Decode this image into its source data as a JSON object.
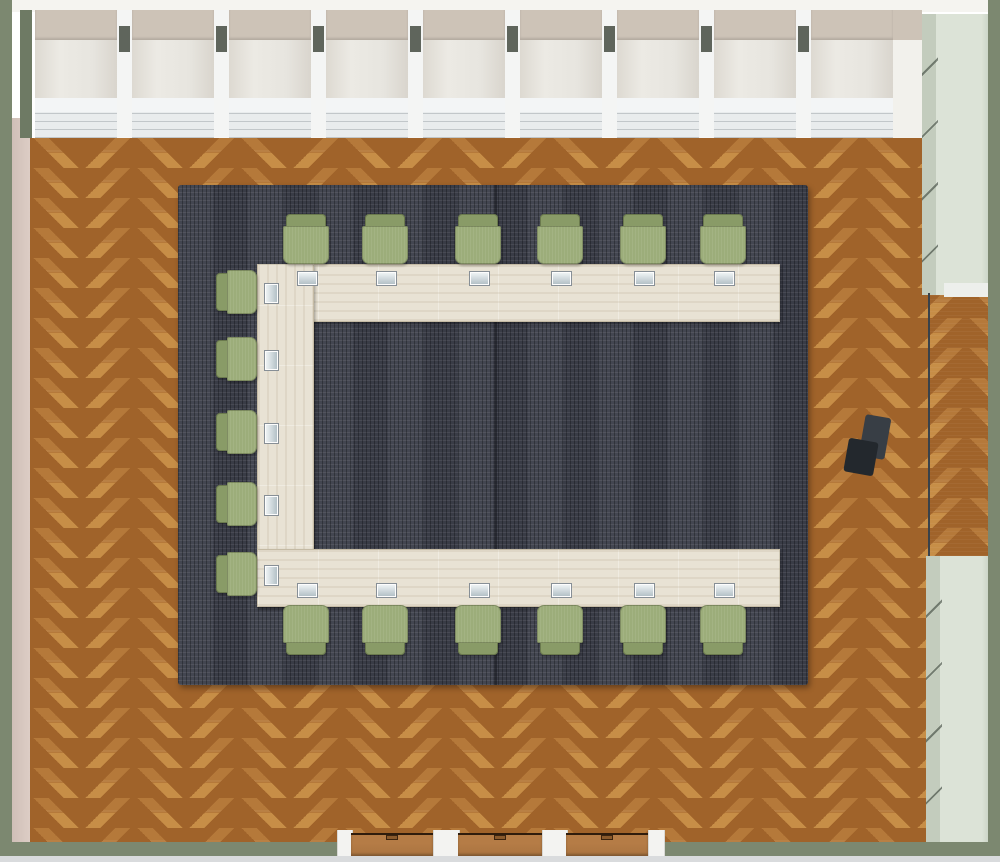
{
  "scene": {
    "description": "Top-down 3D floor plan of a conference room with a C-shaped whitewashed wood table, 17 sage-green chairs, place cards, dark woven rug on herringbone parquet, window wall at top, three wooden doors at bottom, sage storage cabinets and a dark wall niche on the right",
    "counts": {
      "chairs": 17,
      "place_cards": 17,
      "window_units": 9,
      "doors": 3,
      "cabinets": 2,
      "rugs": 1,
      "tables": 1
    },
    "colors": {
      "floor_wood": "#b5793a",
      "floor_wood_dark": "#a0632a",
      "floor_wood_light": "#c78e47",
      "rug": "#3d404b",
      "table_wood": "#e8e2d4",
      "chair_seat": "#9cad7a",
      "chair_back": "#899b67",
      "wall_sage": "#7c8870",
      "wall_inner_pink": "#d8c8c0",
      "window_beige": "#cdc3b7",
      "window_pane": "#e7e5df",
      "window_sill": "#e9eced",
      "mullion_cap": "#5f655c",
      "cabinet_sage": "#dce3d7",
      "niche_dark": "#4d565e",
      "door_wood": "#aa7440",
      "place_card": "#dfe8eb",
      "dark_object": "#2e3338"
    },
    "windows": {
      "count": 9,
      "start_x": 35,
      "unit_width": 82,
      "gap": 15
    },
    "chairs": {
      "top_row_centers_x": [
        306,
        385,
        478,
        560,
        643,
        723
      ],
      "top_row_y": 214,
      "bottom_row_centers_x": [
        306,
        385,
        478,
        560,
        643,
        723
      ],
      "bottom_row_y": 605,
      "left_col_centers_y": [
        292,
        359,
        432,
        504,
        574
      ],
      "left_col_x": 216
    },
    "cards": {
      "top_row_y": 272,
      "bottom_row_y": 584,
      "left_col_x": 265
    },
    "doors": {
      "jambs": [
        {
          "x": 337,
          "w": 14
        },
        {
          "x": 433,
          "w": 25
        },
        {
          "x": 542,
          "w": 24
        },
        {
          "x": 648,
          "w": 15
        }
      ],
      "leaves": [
        {
          "x": 351,
          "w": 82
        },
        {
          "x": 458,
          "w": 84
        },
        {
          "x": 566,
          "w": 82
        }
      ]
    }
  }
}
